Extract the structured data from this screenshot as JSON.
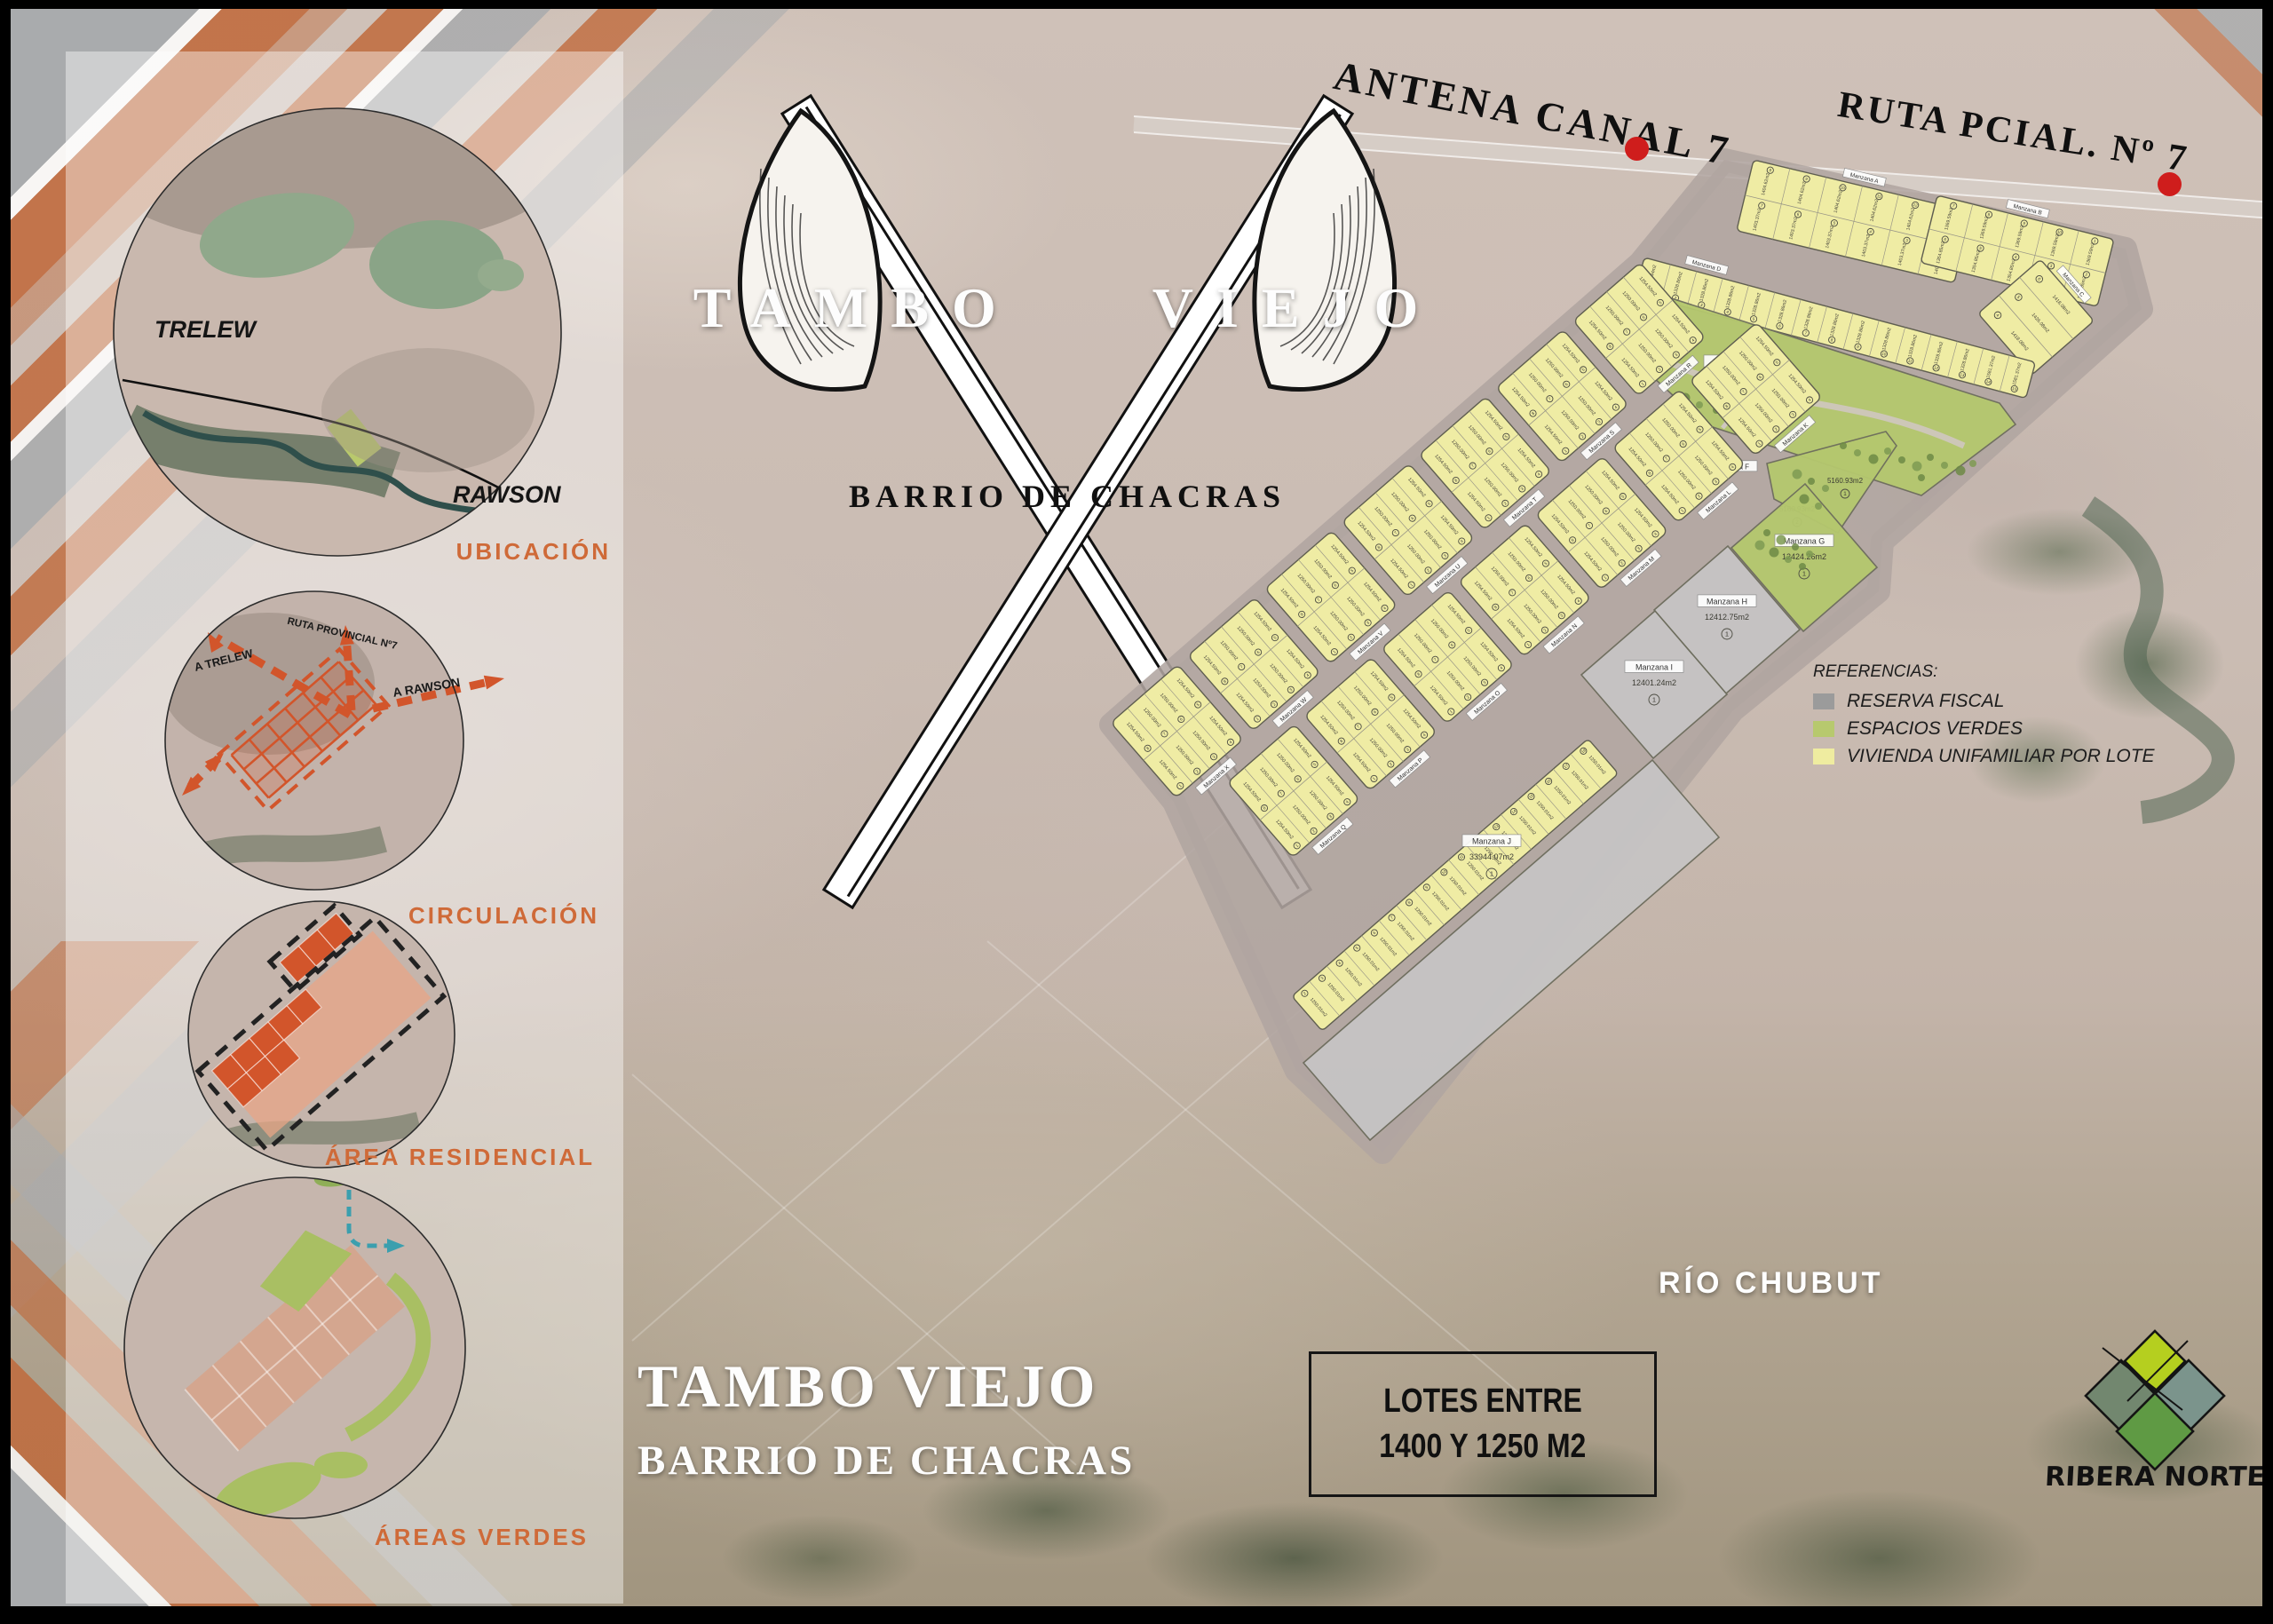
{
  "top_labels": {
    "antena": "ANTENA CANAL 7",
    "ruta": "RUTA PCIAL. Nº 7"
  },
  "logo": {
    "word1": "TAMBO",
    "word2": "VIEJO",
    "subtitle": "BARRIO DE CHACRAS"
  },
  "sidebar": {
    "sections": [
      {
        "label": "UBICACIÓN",
        "annotations": [
          "TRELEW",
          "RAWSON"
        ]
      },
      {
        "label": "CIRCULACIÓN",
        "annotations": [
          "A TRELEW",
          "RUTA PROVINCIAL Nº7",
          "A RAWSON"
        ]
      },
      {
        "label": "ÁREA RESIDENCIAL",
        "annotations": []
      },
      {
        "label": "ÁREAS VERDES",
        "annotations": []
      }
    ]
  },
  "legend": {
    "title": "REFERENCIAS:",
    "items": [
      {
        "label": "RESERVA FISCAL",
        "color": "#9b9b9b"
      },
      {
        "label": "ESPACIOS VERDES",
        "color": "#b7c96e"
      },
      {
        "label": "VIVIENDA UNIFAMILIAR POR LOTE",
        "color": "#efeca0"
      }
    ]
  },
  "river_label": "RÍO CHUBUT",
  "footer": {
    "title": "TAMBO VIEJO",
    "subtitle": "BARRIO DE CHACRAS",
    "box_line1": "LOTES ENTRE",
    "box_line2": "1400 Y 1250 M2"
  },
  "brand": {
    "name": "RIBERA NORTE"
  },
  "colors": {
    "accent_orange": "#cf6a38",
    "lot_yellow": "#efeca4",
    "green_space": "#b5c86e",
    "reserve_gray": "#c6c4c4",
    "street": "#b2a7a2",
    "dash_orange": "#d2552b",
    "teal": "#3b9fae"
  },
  "plan": {
    "label_prefix": "Manzana",
    "strips": [
      {
        "id": "A",
        "label": "Manzana A",
        "rows": [
          [
            {
              "n": "8",
              "a": "1404.62m2"
            },
            {
              "n": "9",
              "a": "1404.62m2"
            },
            {
              "n": "10",
              "a": "1404.62m2"
            },
            {
              "n": "11",
              "a": "1404.62m2"
            },
            {
              "n": "12",
              "a": "1404.62m2"
            },
            {
              "n": "1",
              "a": "1404.62m2"
            }
          ],
          [
            {
              "n": "7",
              "a": "1403.37m2"
            },
            {
              "n": "6",
              "a": "1403.37m2"
            },
            {
              "n": "5",
              "a": "1403.37m2"
            },
            {
              "n": "4",
              "a": "1403.37m2"
            },
            {
              "n": "3",
              "a": "1403.37m2"
            },
            {
              "n": "2",
              "a": "1403.37m2"
            }
          ]
        ]
      },
      {
        "id": "B",
        "label": "Manzana B",
        "rows": [
          [
            {
              "n": "7",
              "a": "1369.59m2"
            },
            {
              "n": "8",
              "a": "1369.59m2"
            },
            {
              "n": "9",
              "a": "1369.59m2"
            },
            {
              "n": "10",
              "a": "1369.59m2"
            },
            {
              "n": "1",
              "a": "1369.59m2"
            }
          ],
          [
            {
              "n": "6",
              "a": "1354.85m2"
            },
            {
              "n": "5",
              "a": "1354.85m2"
            },
            {
              "n": "4",
              "a": "1354.85m2"
            },
            {
              "n": "3",
              "a": "1354.85m2"
            },
            {
              "n": "2",
              "a": "1354.85m2"
            }
          ]
        ]
      },
      {
        "id": "C",
        "label": "Manzana C",
        "rows": [
          [
            {
              "n": "6",
              "a": "1418.08m2"
            }
          ],
          [
            {
              "n": "5",
              "a": "1426.08m2"
            }
          ],
          [
            {
              "n": "4",
              "a": "1418.08m2"
            }
          ]
        ]
      },
      {
        "id": "D",
        "label": "Manzana D",
        "rows": [
          [
            {
              "n": "1",
              "a": "1242.44m2"
            },
            {
              "n": "2",
              "a": "1328.86m2"
            },
            {
              "n": "3",
              "a": "1328.86m2"
            },
            {
              "n": "4",
              "a": "1328.86m2"
            },
            {
              "n": "5",
              "a": "1328.86m2"
            },
            {
              "n": "6",
              "a": "1328.86m2"
            },
            {
              "n": "7",
              "a": "1328.86m2"
            },
            {
              "n": "8",
              "a": "1328.86m2"
            },
            {
              "n": "9",
              "a": "1328.86m2"
            },
            {
              "n": "10",
              "a": "1328.86m2"
            },
            {
              "n": "11",
              "a": "1328.86m2"
            },
            {
              "n": "12",
              "a": "1328.86m2"
            },
            {
              "n": "13",
              "a": "1328.86m2"
            },
            {
              "n": "14",
              "a": "1581.37m2"
            },
            {
              "n": "15",
              "a": "1581.37m2"
            }
          ]
        ]
      },
      {
        "id": "JL",
        "label": "",
        "rows": [
          [
            {
              "n": "2",
              "a": "1250.01m2"
            },
            {
              "n": "3",
              "a": "1250.01m2"
            },
            {
              "n": "4",
              "a": "1250.01m2"
            },
            {
              "n": "5",
              "a": "1250.01m2"
            },
            {
              "n": "6",
              "a": "1250.01m2"
            },
            {
              "n": "7",
              "a": "1250.01m2"
            },
            {
              "n": "8",
              "a": "1250.01m2"
            },
            {
              "n": "9",
              "a": "1250.01m2"
            },
            {
              "n": "10",
              "a": "1250.01m2"
            },
            {
              "n": "11",
              "a": "1250.01m2"
            },
            {
              "n": "12",
              "a": "1250.01m2"
            },
            {
              "n": "13",
              "a": "1250.01m2"
            },
            {
              "n": "14",
              "a": "1250.01m2"
            },
            {
              "n": "15",
              "a": "1250.01m2"
            },
            {
              "n": "16",
              "a": "1250.01m2"
            },
            {
              "n": "17",
              "a": "1250.01m2"
            },
            {
              "n": "18",
              "a": "1250.01m2"
            }
          ]
        ]
      }
    ],
    "areas": [
      {
        "id": "E",
        "label": "Manzana E",
        "type": "green",
        "area": "40162.97m2",
        "n": "1"
      },
      {
        "id": "F",
        "label": "Manzana F",
        "type": "green",
        "area": "5160.93m2",
        "n": "1",
        "sublots": [
          {
            "n": "1",
            "a": "5160.93m2"
          },
          {
            "n": "2",
            "a": "5160.93m2"
          }
        ]
      },
      {
        "id": "G",
        "label": "Manzana G",
        "type": "green",
        "area": "12424.26m2",
        "n": "1"
      },
      {
        "id": "H",
        "label": "Manzana H",
        "type": "reserve",
        "area": "12412.75m2",
        "n": "1"
      },
      {
        "id": "I",
        "label": "Manzana I",
        "type": "reserve",
        "area": "12401.24m2",
        "n": "1"
      },
      {
        "id": "J",
        "label": "Manzana J",
        "type": "reserve",
        "area": "33944.07m2",
        "n": "1"
      }
    ],
    "small_blocks": {
      "row1_letters": [
        "X",
        "W",
        "V",
        "U",
        "T",
        "S",
        "R"
      ],
      "row2_letters": [
        "Q",
        "P",
        "O",
        "N",
        "M",
        "L",
        "K"
      ],
      "lot_rows": [
        [
          {
            "n": "8",
            "a": "1254.50m2"
          },
          {
            "n": "7",
            "a": "1250.00m2"
          },
          {
            "n": "6",
            "a": "1250.00m2"
          },
          {
            "n": "5",
            "a": "1254.50m2"
          }
        ],
        [
          {
            "n": "1",
            "a": "1254.50m2"
          },
          {
            "n": "2",
            "a": "1250.00m2"
          },
          {
            "n": "3",
            "a": "1250.00m2"
          },
          {
            "n": "4",
            "a": "1254.50m2"
          }
        ]
      ]
    }
  }
}
